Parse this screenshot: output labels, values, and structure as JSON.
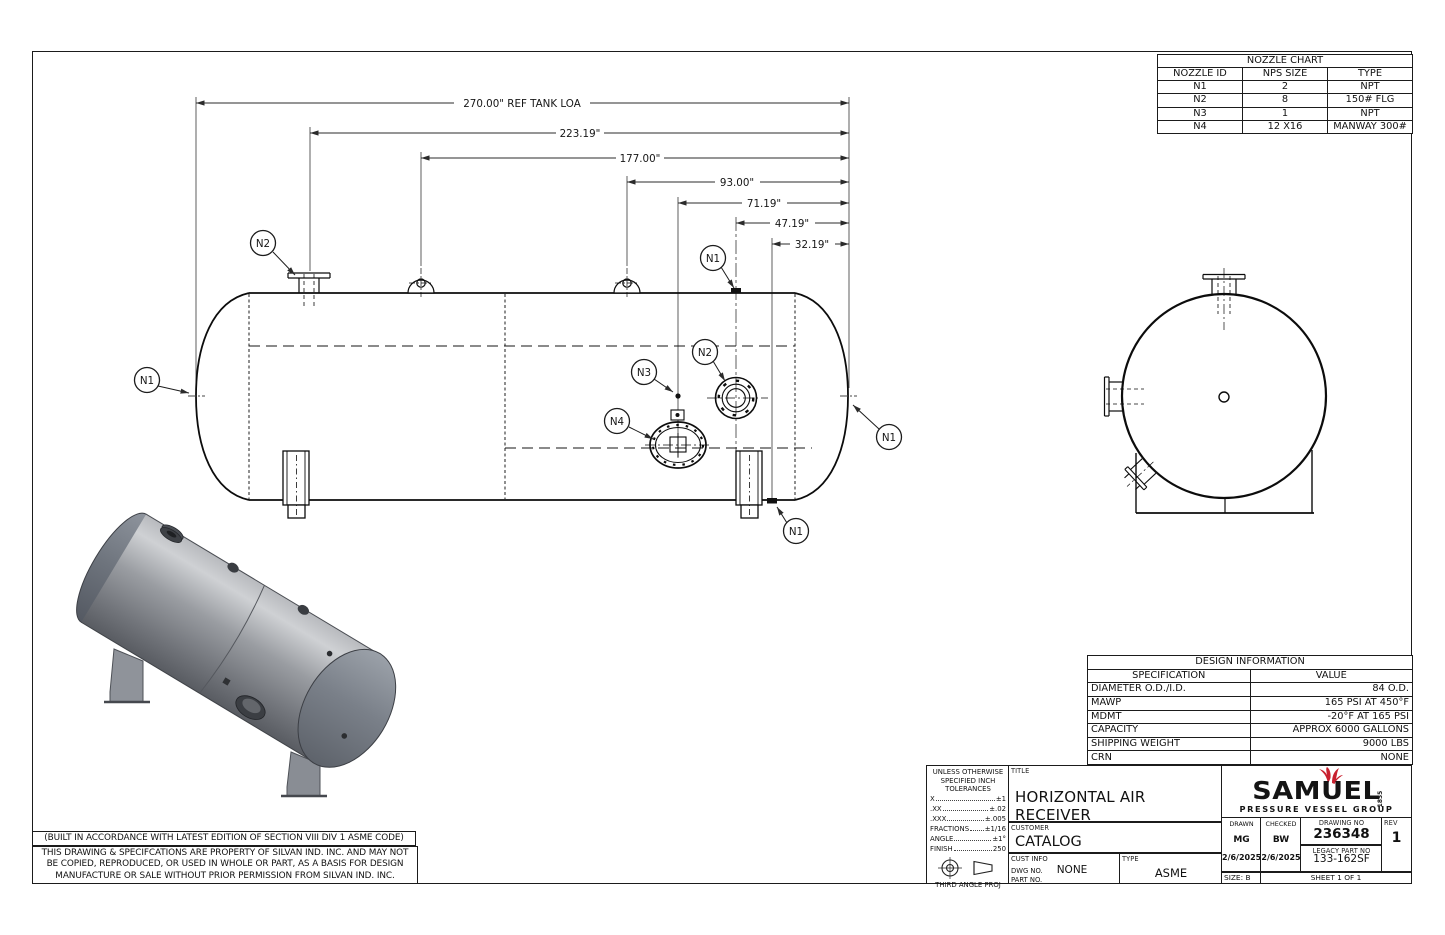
{
  "nozzle_chart": {
    "title": "NOZZLE CHART",
    "headers": [
      "NOZZLE ID",
      "NPS SIZE",
      "TYPE"
    ],
    "rows": [
      [
        "N1",
        "2",
        "NPT"
      ],
      [
        "N2",
        "8",
        "150# FLG"
      ],
      [
        "N3",
        "1",
        "NPT"
      ],
      [
        "N4",
        "12 X16",
        "MANWAY 300#"
      ]
    ]
  },
  "dims": [
    "270.00\" REF TANK LOA",
    "223.19\"",
    "177.00\"",
    "93.00\"",
    "71.19\"",
    "47.19\"",
    "32.19\""
  ],
  "balloons": {
    "n2_top": "N2",
    "n1_left": "N1",
    "n1_top": "N1",
    "n3": "N3",
    "n2_side": "N2",
    "n4": "N4",
    "n1_right": "N1",
    "n1_bottom": "N1"
  },
  "design_information": {
    "title": "DESIGN INFORMATION",
    "headers": [
      "SPECIFICATION",
      "VALUE"
    ],
    "rows": [
      [
        "DIAMETER O.D./I.D.",
        "84 O.D."
      ],
      [
        "MAWP",
        "165 PSI AT 450°F"
      ],
      [
        "MDMT",
        "-20°F AT 165 PSI"
      ],
      [
        "CAPACITY",
        "APPROX 6000 GALLONS"
      ],
      [
        "SHIPPING WEIGHT",
        "9000 LBS"
      ],
      [
        "CRN",
        "NONE"
      ]
    ]
  },
  "notes": {
    "asme": "(BUILT IN ACCORDANCE WITH LATEST EDITION OF SECTION VIII DIV 1 ASME CODE)",
    "property": [
      "THIS DRAWING & SPECIFCATIONS ARE PROPERTY OF SILVAN IND. INC. AND MAY NOT",
      "BE COPIED, REPRODUCED, OR USED IN WHOLE OR PART, AS A BASIS FOR DESIGN",
      "MANUFACTURE OR SALE WITHOUT PRIOR PERMISSION FROM SILVAN IND. INC."
    ]
  },
  "tolerances": {
    "heading": [
      "UNLESS OTHERWISE",
      "SPECIFIED INCH",
      "TOLERANCES"
    ],
    "items": [
      {
        "name": "X",
        "value": "±1"
      },
      {
        "name": ".XX",
        "value": "±.02"
      },
      {
        "name": ".XXX",
        "value": "±.005"
      },
      {
        "name": "FRACTIONS",
        "value": "±1/16"
      },
      {
        "name": "ANGLE",
        "value": "±1°"
      },
      {
        "name": "FINISH",
        "value": "250"
      }
    ],
    "projection": "THIRD ANGLE PROJ"
  },
  "title_block": {
    "title_label": "TITLE",
    "title": "HORIZONTAL AIR RECEIVER",
    "customer_label": "CUSTOMER",
    "customer": "CATALOG",
    "cust_info_label": "CUST INFO",
    "dwg_no_label": "DWG NO.",
    "dwg_no": "NONE",
    "part_no_label": "PART NO.",
    "type_label": "TYPE",
    "type": "ASME",
    "drawn_label": "DRAWN",
    "drawn_by": "MG",
    "drawn_date": "2/6/2025",
    "checked_label": "CHECKED",
    "checked_by": "BW",
    "checked_date": "2/6/2025",
    "drawing_no_label": "DRAWING NO",
    "drawing_no": "236348",
    "legacy_label": "LEGACY PART NO",
    "legacy_no": "133-162SF",
    "rev_label": "REV",
    "rev": "1",
    "size": "SIZE: B",
    "sheet": "SHEET 1 OF 1"
  },
  "logo": {
    "brand": "SAMUEL",
    "year": "1855",
    "tagline": "PRESSURE VESSEL GROUP",
    "accent": "#c8202f"
  }
}
